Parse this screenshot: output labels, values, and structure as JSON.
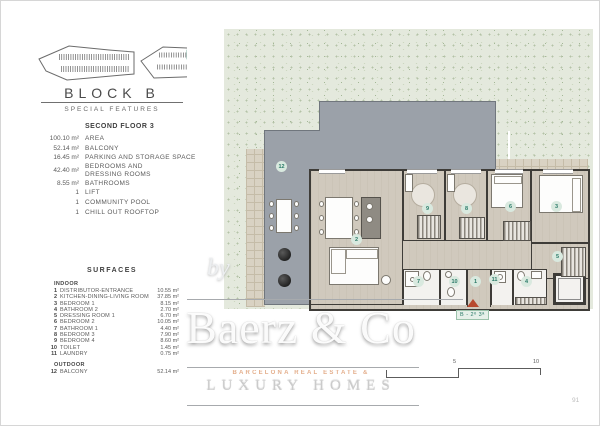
{
  "colors": {
    "garden": "#e4e9dd",
    "badge_bg": "#d9e9df",
    "badge_text": "#2a7a68",
    "entry_red": "#b8492f",
    "orange": "#dfa077"
  },
  "header": {
    "block": "BLOCK B",
    "subtitle": "SPECIAL FEATURES",
    "site_marker": "B"
  },
  "features": {
    "title": "SECOND FLOOR 3",
    "items": [
      {
        "value": "100.10 m²",
        "label": "AREA"
      },
      {
        "value": "52.14 m²",
        "label": "BALCONY"
      },
      {
        "value": "16.45 m²",
        "label": "PARKING AND STORAGE SPACE"
      },
      {
        "value": "42.40 m²",
        "label": "BEDROOMS AND\nDRESSING ROOMS"
      },
      {
        "value": "8.55 m²",
        "label": "BATHROOMS"
      },
      {
        "value": "1",
        "label": "LIFT"
      },
      {
        "value": "1",
        "label": "COMMUNITY POOL"
      },
      {
        "value": "1",
        "label": "CHILL OUT ROOFTOP"
      }
    ]
  },
  "surfaces": {
    "title": "SURFACES",
    "indoor_label": "INDOOR",
    "outdoor_label": "OUTDOOR",
    "indoor": [
      {
        "num": "1",
        "label": "DISTRIBUTOR-ENTRANCE",
        "value": "10.55 m²"
      },
      {
        "num": "2",
        "label": "KITCHEN-DINING-LIVING ROOM",
        "value": "37.85 m²"
      },
      {
        "num": "3",
        "label": "BEDROOM 1",
        "value": "8.15 m²"
      },
      {
        "num": "4",
        "label": "BATHROOM 2",
        "value": "2.70 m²"
      },
      {
        "num": "5",
        "label": "DRESSING ROOM 1",
        "value": "6.70 m²"
      },
      {
        "num": "6",
        "label": "BEDROOM 2",
        "value": "10.05 m²"
      },
      {
        "num": "7",
        "label": "BATHROOM 1",
        "value": "4.40 m²"
      },
      {
        "num": "8",
        "label": "BEDROOM 3",
        "value": "7.90 m²"
      },
      {
        "num": "9",
        "label": "BEDROOM 4",
        "value": "8.60 m²"
      },
      {
        "num": "10",
        "label": "TOILET",
        "value": "1.45 m²"
      },
      {
        "num": "11",
        "label": "LAUNDRY",
        "value": "0.75 m²"
      }
    ],
    "outdoor": [
      {
        "num": "12",
        "label": "BALCONY",
        "value": "52.14 m²"
      }
    ]
  },
  "plan": {
    "rooms": {
      "r1": "1",
      "r2": "2",
      "r3": "3",
      "r4": "4",
      "r5": "5",
      "r6": "6",
      "r7": "7",
      "r8": "8",
      "r9": "9",
      "r10": "10",
      "r11": "11",
      "r12": "12"
    },
    "entrance_label": "B - 2º 3ª",
    "scale": {
      "five": "5",
      "ten": "10"
    }
  },
  "watermark": {
    "by": "by",
    "brand": "Baerz & Co",
    "tagline": "BARCELONA REAL ESTATE &",
    "subbrand": "LUXURY HOMES"
  },
  "page": {
    "number": "91"
  }
}
